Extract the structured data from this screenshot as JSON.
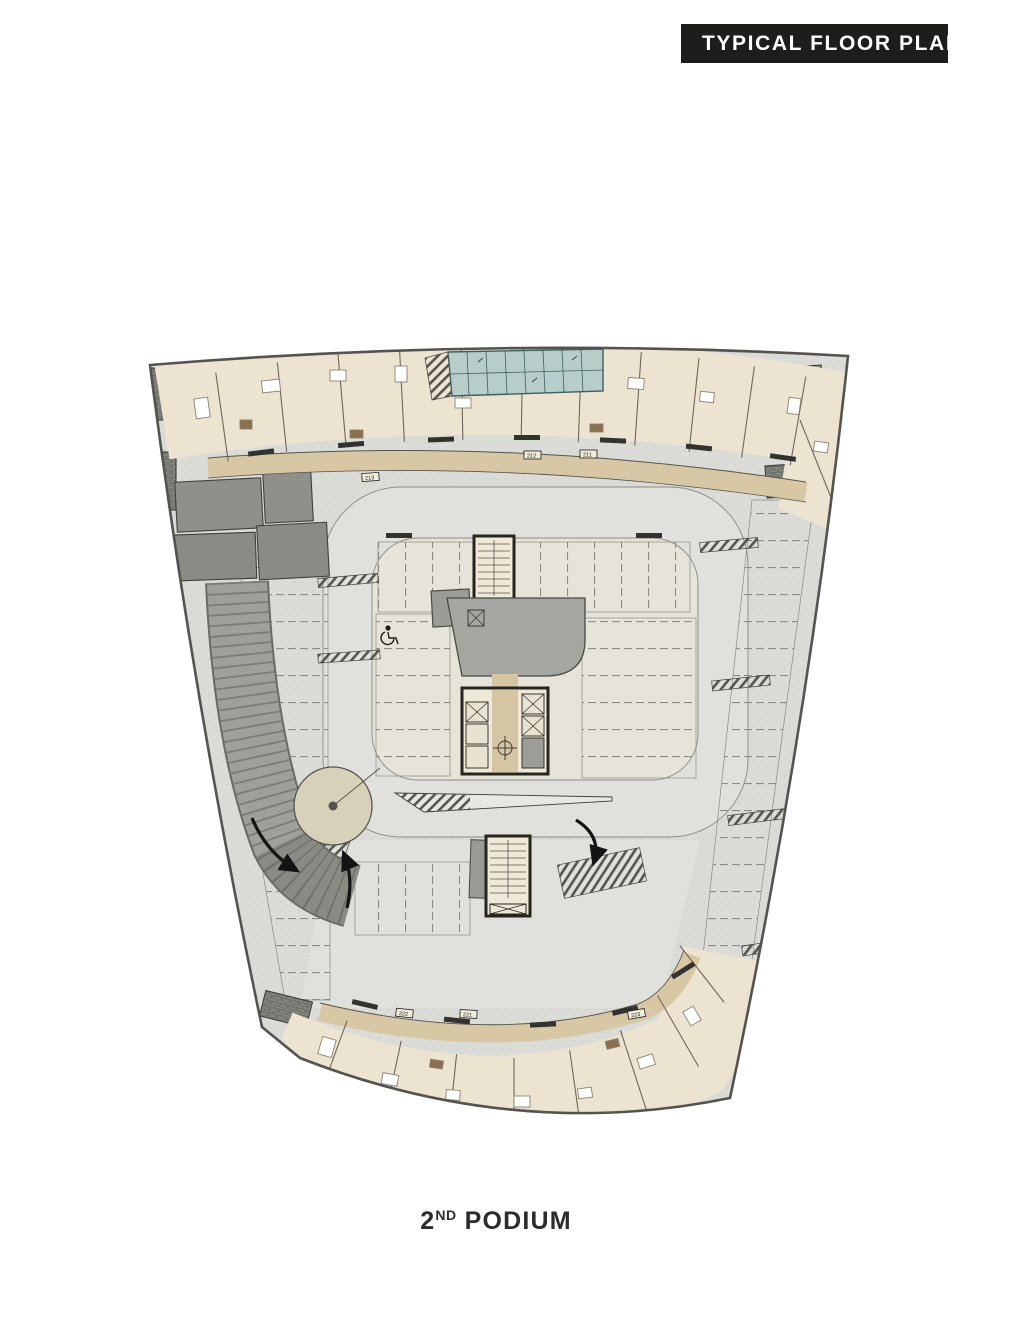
{
  "header": {
    "title": "TYPICAL FLOOR PLAN"
  },
  "caption": {
    "number": "2",
    "ordinal": "ND",
    "text": "PODIUM"
  },
  "plan": {
    "type": "architectural-floor-plan",
    "level": "2nd podium (parking level with perimeter apartments)",
    "unit_tags": {
      "top": [
        "213",
        "212",
        "211"
      ],
      "bottom": [
        "222",
        "221",
        "223"
      ]
    },
    "colors": {
      "banner_bg": "#1d1d1b",
      "banner_text": "#ffffff",
      "caption_text": "#2c2c2c",
      "apartment_fill": "#ece4d1",
      "corridor_fill": "#d8c7a5",
      "parking_field": "#dbdbd7",
      "parking_island": "#e6e3d8",
      "service_gray": "#8f8f8a",
      "ramp_gray": "#a0a09b",
      "pool_teal": "#b7cdca",
      "wall_ink": "#3a3a36"
    }
  }
}
